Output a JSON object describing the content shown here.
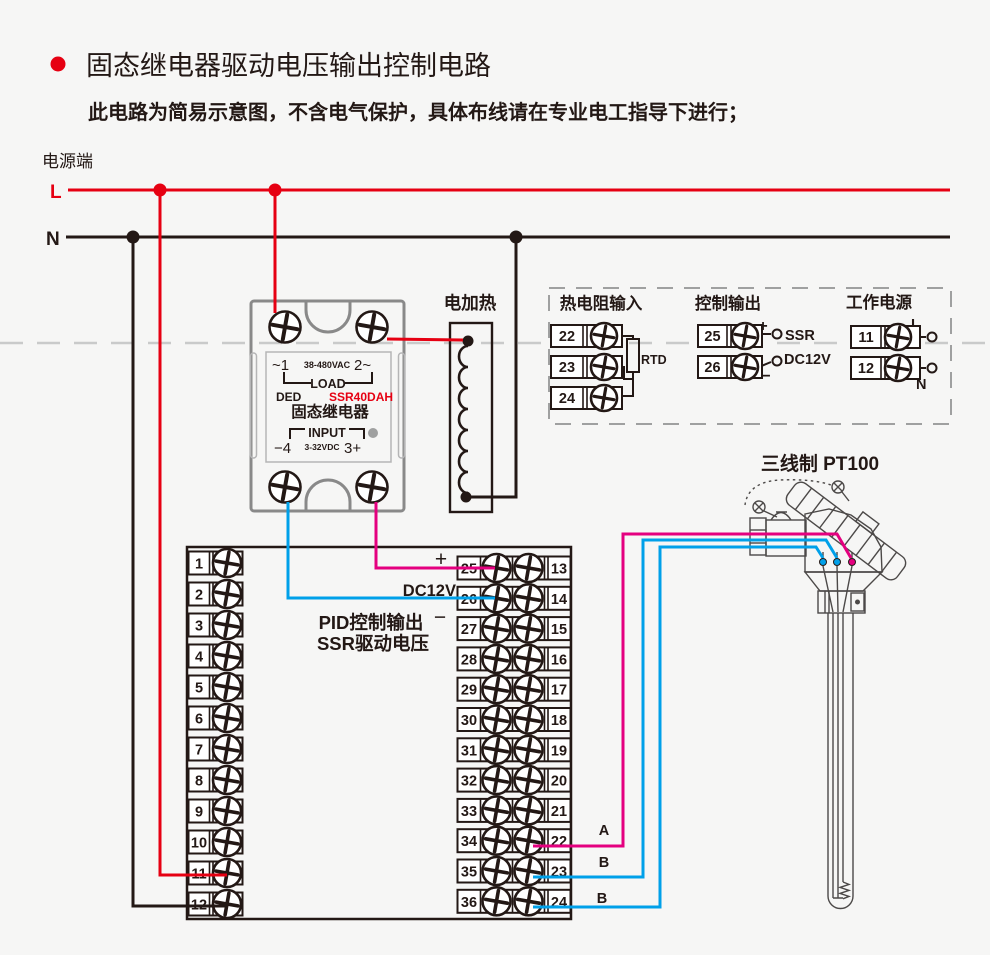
{
  "header": {
    "title": "固态继电器驱动电压输出控制电路",
    "subtitle": "此电路为简易示意图，不含电气保护，具体布线请在专业电工指导下进行；",
    "bullet_color": "#e60012"
  },
  "power": {
    "label": "电源端",
    "live": "L",
    "neutral": "N"
  },
  "colors": {
    "live_wire": "#e60012",
    "neutral_wire": "#231815",
    "plus_wire": "#e4007f",
    "minus_wire": "#00a0e9",
    "outline_gray": "#898989",
    "dash_gray": "#c9caca"
  },
  "ssr": {
    "terminal_1": "~1",
    "load_voltage": "38-480VAC",
    "terminal_2": "2~",
    "load_label": "LOAD",
    "brand": "DED",
    "model": "SSR40DAH",
    "name": "固态继电器",
    "input_label": "INPUT",
    "terminal_4": "−4",
    "input_voltage": "3-32VDC",
    "terminal_3": "3+"
  },
  "heater": {
    "label": "电加热"
  },
  "io_panel": {
    "rtd": {
      "title": "热电阻输入",
      "terminals": [
        "22",
        "23",
        "24"
      ],
      "sensor_label": "RTD"
    },
    "control": {
      "title": "控制输出",
      "terminals": [
        "25",
        "26"
      ],
      "plus": "+",
      "minus": "−",
      "line1": "SSR",
      "line2": "DC12V"
    },
    "supply": {
      "title": "工作电源",
      "terminals": [
        "11",
        "12"
      ],
      "live": "L",
      "neutral": "N"
    }
  },
  "sensor": {
    "label": "三线制 PT100",
    "wire_a": "A",
    "wire_b1": "B",
    "wire_b2": "B"
  },
  "terminal_block": {
    "left": [
      "1",
      "2",
      "3",
      "4",
      "5",
      "6",
      "7",
      "8",
      "9",
      "10",
      "11",
      "12"
    ],
    "inner": [
      "25",
      "26",
      "27",
      "28",
      "29",
      "30",
      "31",
      "32",
      "33",
      "34",
      "35",
      "36"
    ],
    "outer": [
      "13",
      "14",
      "15",
      "16",
      "17",
      "18",
      "19",
      "20",
      "21",
      "22",
      "23",
      "24"
    ],
    "plus": "+",
    "dc12v": "DC12V",
    "minus": "−",
    "note_line1": "PID控制输出",
    "note_line2": "SSR驱动电压"
  }
}
